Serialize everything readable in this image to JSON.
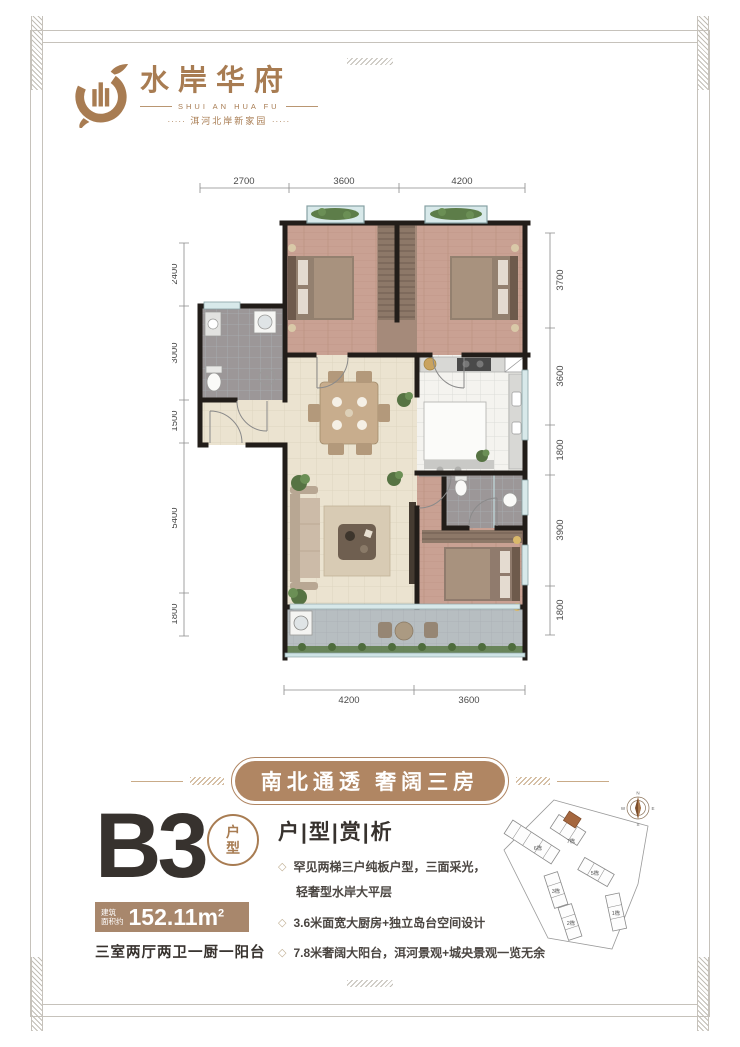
{
  "brand": {
    "name": "水岸华府",
    "pinyin": "SHUI AN HUA FU",
    "tagline": "洱河北岸新家园",
    "tagline_dots_left": "·····",
    "tagline_dots_right": "·····"
  },
  "floor_plan": {
    "dims_top": [
      "2700",
      "3600",
      "4200"
    ],
    "dims_left": [
      "2400",
      "3000",
      "1500",
      "5400",
      "1800"
    ],
    "dims_right": [
      "3700",
      "3600",
      "1800",
      "3900",
      "1800"
    ],
    "dims_bottom": [
      "4200",
      "3600"
    ]
  },
  "banner": {
    "text": "南北通透 奢阔三房"
  },
  "unit": {
    "code": "B3",
    "badge_line1": "户",
    "badge_line2": "型",
    "area_label_line1": "建筑",
    "area_label_line2": "面积约",
    "area_value": "152.11m",
    "area_sup": "2",
    "rooms_desc": "三室两厅两卫一厨一阳台"
  },
  "analysis": {
    "title": "户|型|赏|析",
    "bullet_icon": "◇",
    "bullets": [
      "罕见两梯三户纯板户型，三面采光，",
      "轻奢型水岸大平层",
      "3.6米面宽大厨房+独立岛台空间设计",
      "7.8米奢阔大阳台，洱河景观+城央景观一览无余"
    ]
  },
  "site_plan": {
    "buildings": [
      "6栋",
      "7栋",
      "5栋",
      "3栋",
      "2栋",
      "1栋"
    ],
    "highlighted_building": "7栋",
    "compass": {
      "n": "N",
      "e": "E",
      "s": "S",
      "w": "W"
    }
  },
  "colors": {
    "brand": "#a87c52",
    "banner_fill": "#b08663",
    "area_bar": "#a8876c",
    "dark_text": "#37322e",
    "highlight_unit": "#a5673f"
  }
}
